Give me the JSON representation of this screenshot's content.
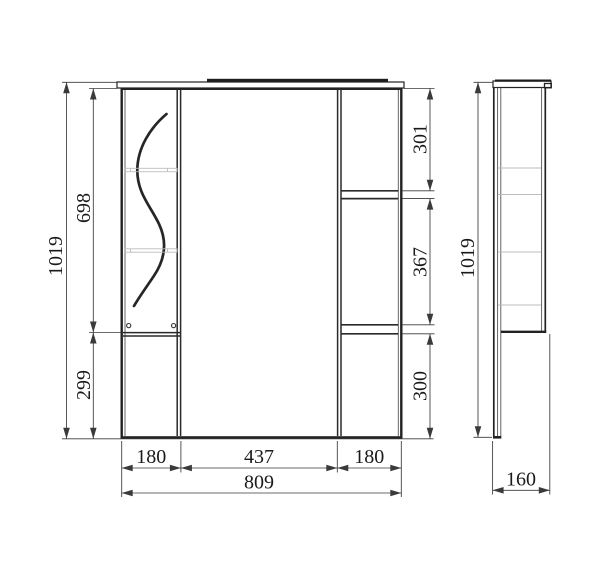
{
  "drawing": {
    "colors": {
      "outline": "#222222",
      "dimension_lines": "#3a3a3a",
      "text": "#1a1a1a",
      "faint_detail": "#bdbdbd",
      "background": "#ffffff"
    },
    "front_view": {
      "height_total": "1019",
      "left_top_section": "698",
      "left_bottom_section": "299",
      "right_top_section": "301",
      "right_middle_section": "367",
      "right_bottom_section": "300",
      "bottom_left_section": "180",
      "bottom_middle_section": "437",
      "bottom_right_section": "180",
      "width_total": "809"
    },
    "side_view": {
      "height_total": "1019",
      "depth_total": "160"
    }
  }
}
